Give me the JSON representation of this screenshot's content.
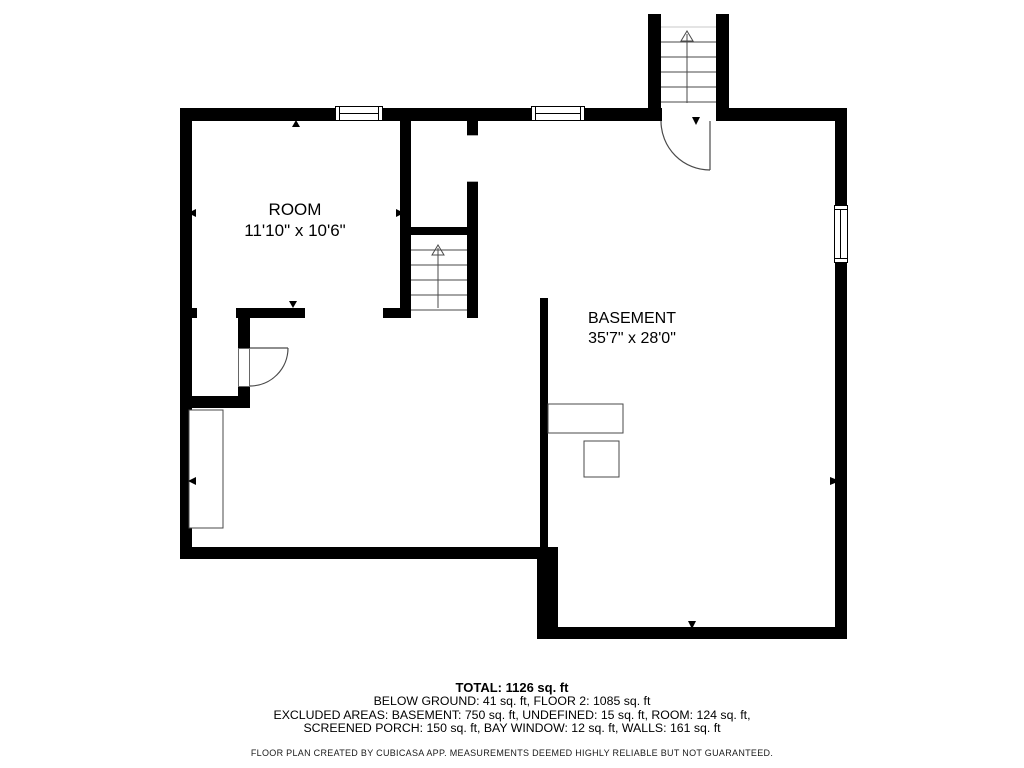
{
  "floor_plan": {
    "rooms": [
      {
        "name": "ROOM",
        "dimensions": "11'10\" x 10'6\""
      },
      {
        "name": "BASEMENT",
        "dimensions": "35'7\" x 28'0\""
      }
    ],
    "summary": {
      "total": "TOTAL: 1126 sq. ft",
      "lines": [
        "BELOW GROUND: 41 sq. ft, FLOOR 2: 1085 sq. ft",
        "EXCLUDED AREAS: BASEMENT: 750 sq. ft, UNDEFINED: 15 sq. ft, ROOM: 124 sq. ft,",
        "SCREENED PORCH: 150 sq. ft, BAY WINDOW: 12 sq. ft, WALLS: 161 sq. ft"
      ]
    },
    "disclaimer": "FLOOR PLAN CREATED BY CUBICASA APP. MEASUREMENTS DEEMED HIGHLY RELIABLE BUT NOT GUARANTEED.",
    "colors": {
      "wall": "#000000",
      "background": "#ffffff",
      "thin_line": "#4a4a4a"
    }
  }
}
